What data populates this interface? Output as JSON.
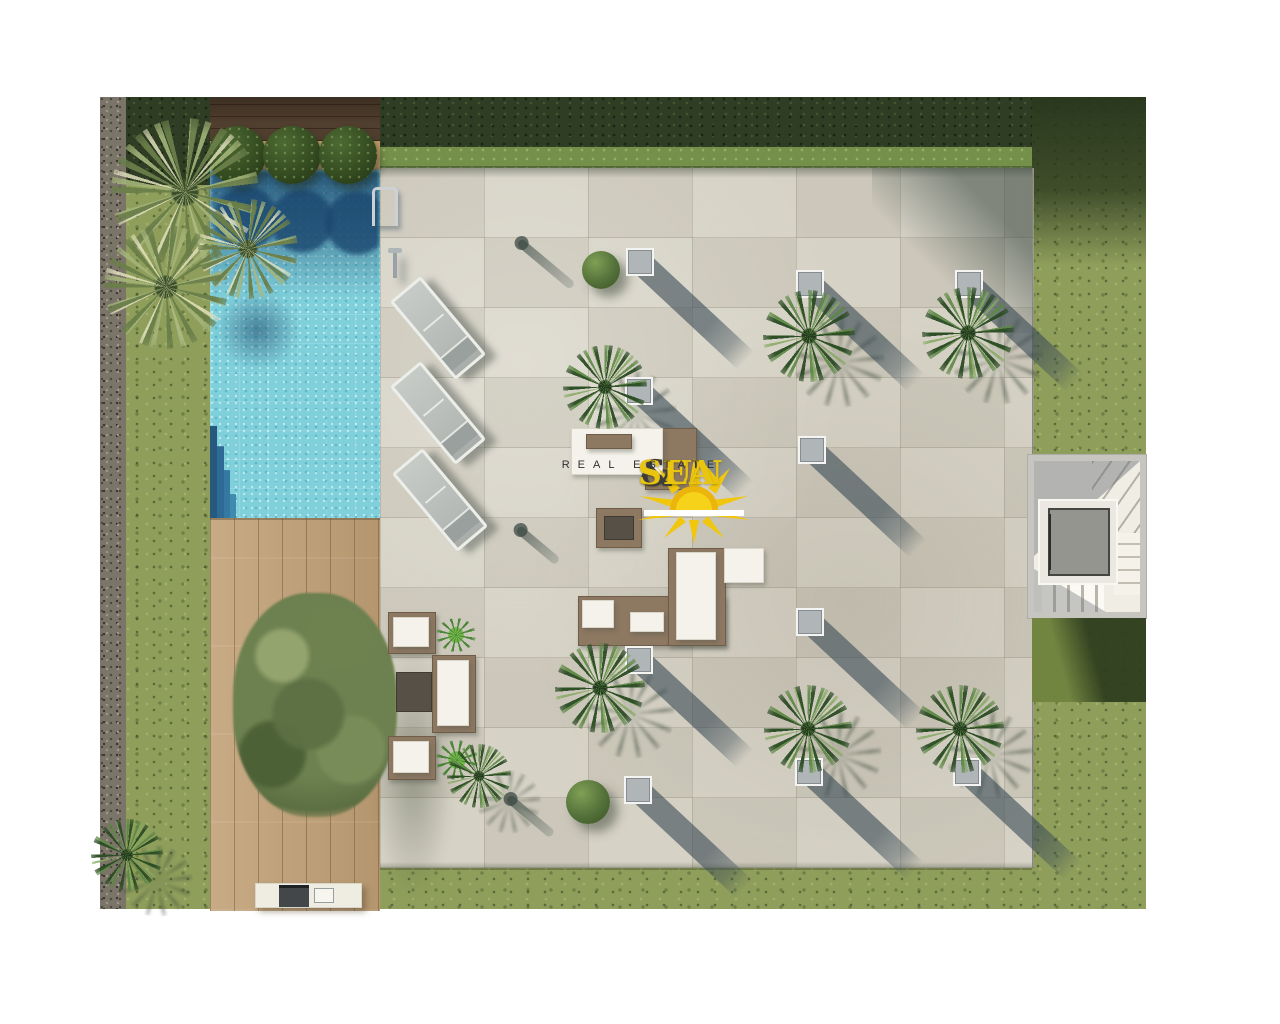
{
  "meta": {
    "image_type": "architectural top-down 3D render",
    "subject": "villa solarium terrace with swimming pool, wooden deck, staircase and garden"
  },
  "watermark": {
    "brand_left": "SUN",
    "brand_amp": "&",
    "brand_right": "SEA",
    "tagline": "REAL ESTATE",
    "brand_color": "#e9c50f",
    "amp_color": "#3d3d3d",
    "tagline_color": "#2f2f2f",
    "sun_icon": "sunrise-icon"
  },
  "palette": {
    "background": "#ffffff",
    "grass": "#8f9e5b",
    "hedge_dark": "#2e3d23",
    "gravel": "#7b7468",
    "terrace_tile": "#d3cfc2",
    "deck_wood": "#bfa077",
    "dark_wood": "#503e2e",
    "pool_water": "#7fd0db",
    "pool_shadow": "#1a466e",
    "skylight_gray": "#b0b5b7",
    "shadow_blue_gray": "#3e4e58",
    "sofa_brown": "#8d7862",
    "cushion_white": "#f4f2ea"
  },
  "scene": {
    "skylights": [
      {
        "x": 538,
        "y": 163
      },
      {
        "x": 708,
        "y": 185
      },
      {
        "x": 867,
        "y": 185
      },
      {
        "x": 537,
        "y": 292
      },
      {
        "x": 710,
        "y": 351
      },
      {
        "x": 708,
        "y": 523
      },
      {
        "x": 537,
        "y": 561
      },
      {
        "x": 536,
        "y": 691
      },
      {
        "x": 707,
        "y": 673
      },
      {
        "x": 865,
        "y": 673
      }
    ],
    "palms": [
      {
        "x": 709,
        "y": 239,
        "r": 46,
        "v": "dark"
      },
      {
        "x": 868,
        "y": 236,
        "r": 46,
        "v": "dark"
      },
      {
        "x": 505,
        "y": 290,
        "r": 42,
        "v": "dark"
      },
      {
        "x": 500,
        "y": 591,
        "r": 45,
        "v": "dark"
      },
      {
        "x": 708,
        "y": 632,
        "r": 44,
        "v": "dark"
      },
      {
        "x": 860,
        "y": 632,
        "r": 44,
        "v": "dark"
      },
      {
        "x": 379,
        "y": 679,
        "r": 32,
        "v": "dark"
      },
      {
        "x": 85,
        "y": 95,
        "r": 74,
        "v": "light"
      },
      {
        "x": 66,
        "y": 190,
        "r": 62,
        "v": "light"
      },
      {
        "x": 148,
        "y": 152,
        "r": 50,
        "v": "light"
      },
      {
        "x": 27,
        "y": 758,
        "r": 36,
        "v": "dark"
      }
    ],
    "bushes": [
      {
        "x": 501,
        "y": 173,
        "r": 19
      },
      {
        "x": 488,
        "y": 705,
        "r": 22
      }
    ],
    "topiary": [
      {
        "x": 137,
        "y": 58,
        "r": 29
      },
      {
        "x": 192,
        "y": 58,
        "r": 29
      },
      {
        "x": 248,
        "y": 58,
        "r": 29
      }
    ],
    "loungers": [
      {
        "x": 335,
        "y": 228
      },
      {
        "x": 335,
        "y": 313
      },
      {
        "x": 337,
        "y": 400
      }
    ],
    "pole_shadows": [
      {
        "x": 419,
        "y": 140,
        "len": 70
      },
      {
        "x": 418,
        "y": 427,
        "len": 52
      },
      {
        "x": 408,
        "y": 696,
        "len": 58
      }
    ],
    "furniture": [
      {
        "cls": "bf",
        "name": "daybed-side-chair",
        "x": 545,
        "y": 331,
        "w": 50,
        "h": 60
      },
      {
        "cls": "wf",
        "name": "daybed",
        "x": 471,
        "y": 331,
        "w": 90,
        "h": 45
      },
      {
        "cls": "bf",
        "name": "daybed-cushion",
        "x": 486,
        "y": 337,
        "w": 44,
        "h": 13
      },
      {
        "cls": "bf",
        "name": "fire-table",
        "x": 496,
        "y": 411,
        "w": 44,
        "h": 38
      },
      {
        "cls": "df",
        "name": "fire-table-top",
        "x": 504,
        "y": 419,
        "w": 28,
        "h": 22
      },
      {
        "cls": "bf",
        "name": "sofa-base-horizontal",
        "x": 478,
        "y": 499,
        "w": 146,
        "h": 48
      },
      {
        "cls": "bf",
        "name": "sofa-base-vertical",
        "x": 568,
        "y": 451,
        "w": 56,
        "h": 96
      },
      {
        "cls": "wf",
        "name": "sofa-back-cushions",
        "x": 576,
        "y": 455,
        "w": 38,
        "h": 86
      },
      {
        "cls": "wf",
        "name": "sofa-pillow",
        "x": 482,
        "y": 503,
        "w": 30,
        "h": 26
      },
      {
        "cls": "wf",
        "name": "sofa-pillow",
        "x": 530,
        "y": 515,
        "w": 32,
        "h": 18
      },
      {
        "cls": "wf",
        "name": "sofa-ottoman",
        "x": 624,
        "y": 451,
        "w": 38,
        "h": 33
      },
      {
        "cls": "bf",
        "name": "armchair",
        "x": 288,
        "y": 515,
        "w": 46,
        "h": 40
      },
      {
        "cls": "wf",
        "name": "armchair-cushion",
        "x": 293,
        "y": 520,
        "w": 34,
        "h": 28
      },
      {
        "cls": "bf",
        "name": "garden-sofa",
        "x": 332,
        "y": 558,
        "w": 42,
        "h": 76
      },
      {
        "cls": "wf",
        "name": "garden-sofa-cushion",
        "x": 337,
        "y": 563,
        "w": 30,
        "h": 64
      },
      {
        "cls": "bf",
        "name": "armchair",
        "x": 288,
        "y": 639,
        "w": 46,
        "h": 42
      },
      {
        "cls": "wf",
        "name": "armchair-cushion",
        "x": 293,
        "y": 644,
        "w": 34,
        "h": 30
      },
      {
        "cls": "df",
        "name": "coffee-table",
        "x": 296,
        "y": 575,
        "w": 34,
        "h": 38
      },
      {
        "cls": "pf",
        "name": "potted-plant",
        "x": 336,
        "y": 521,
        "w": 40,
        "h": 34
      },
      {
        "cls": "pf",
        "name": "potted-plant",
        "x": 336,
        "y": 643,
        "w": 42,
        "h": 40
      }
    ]
  }
}
